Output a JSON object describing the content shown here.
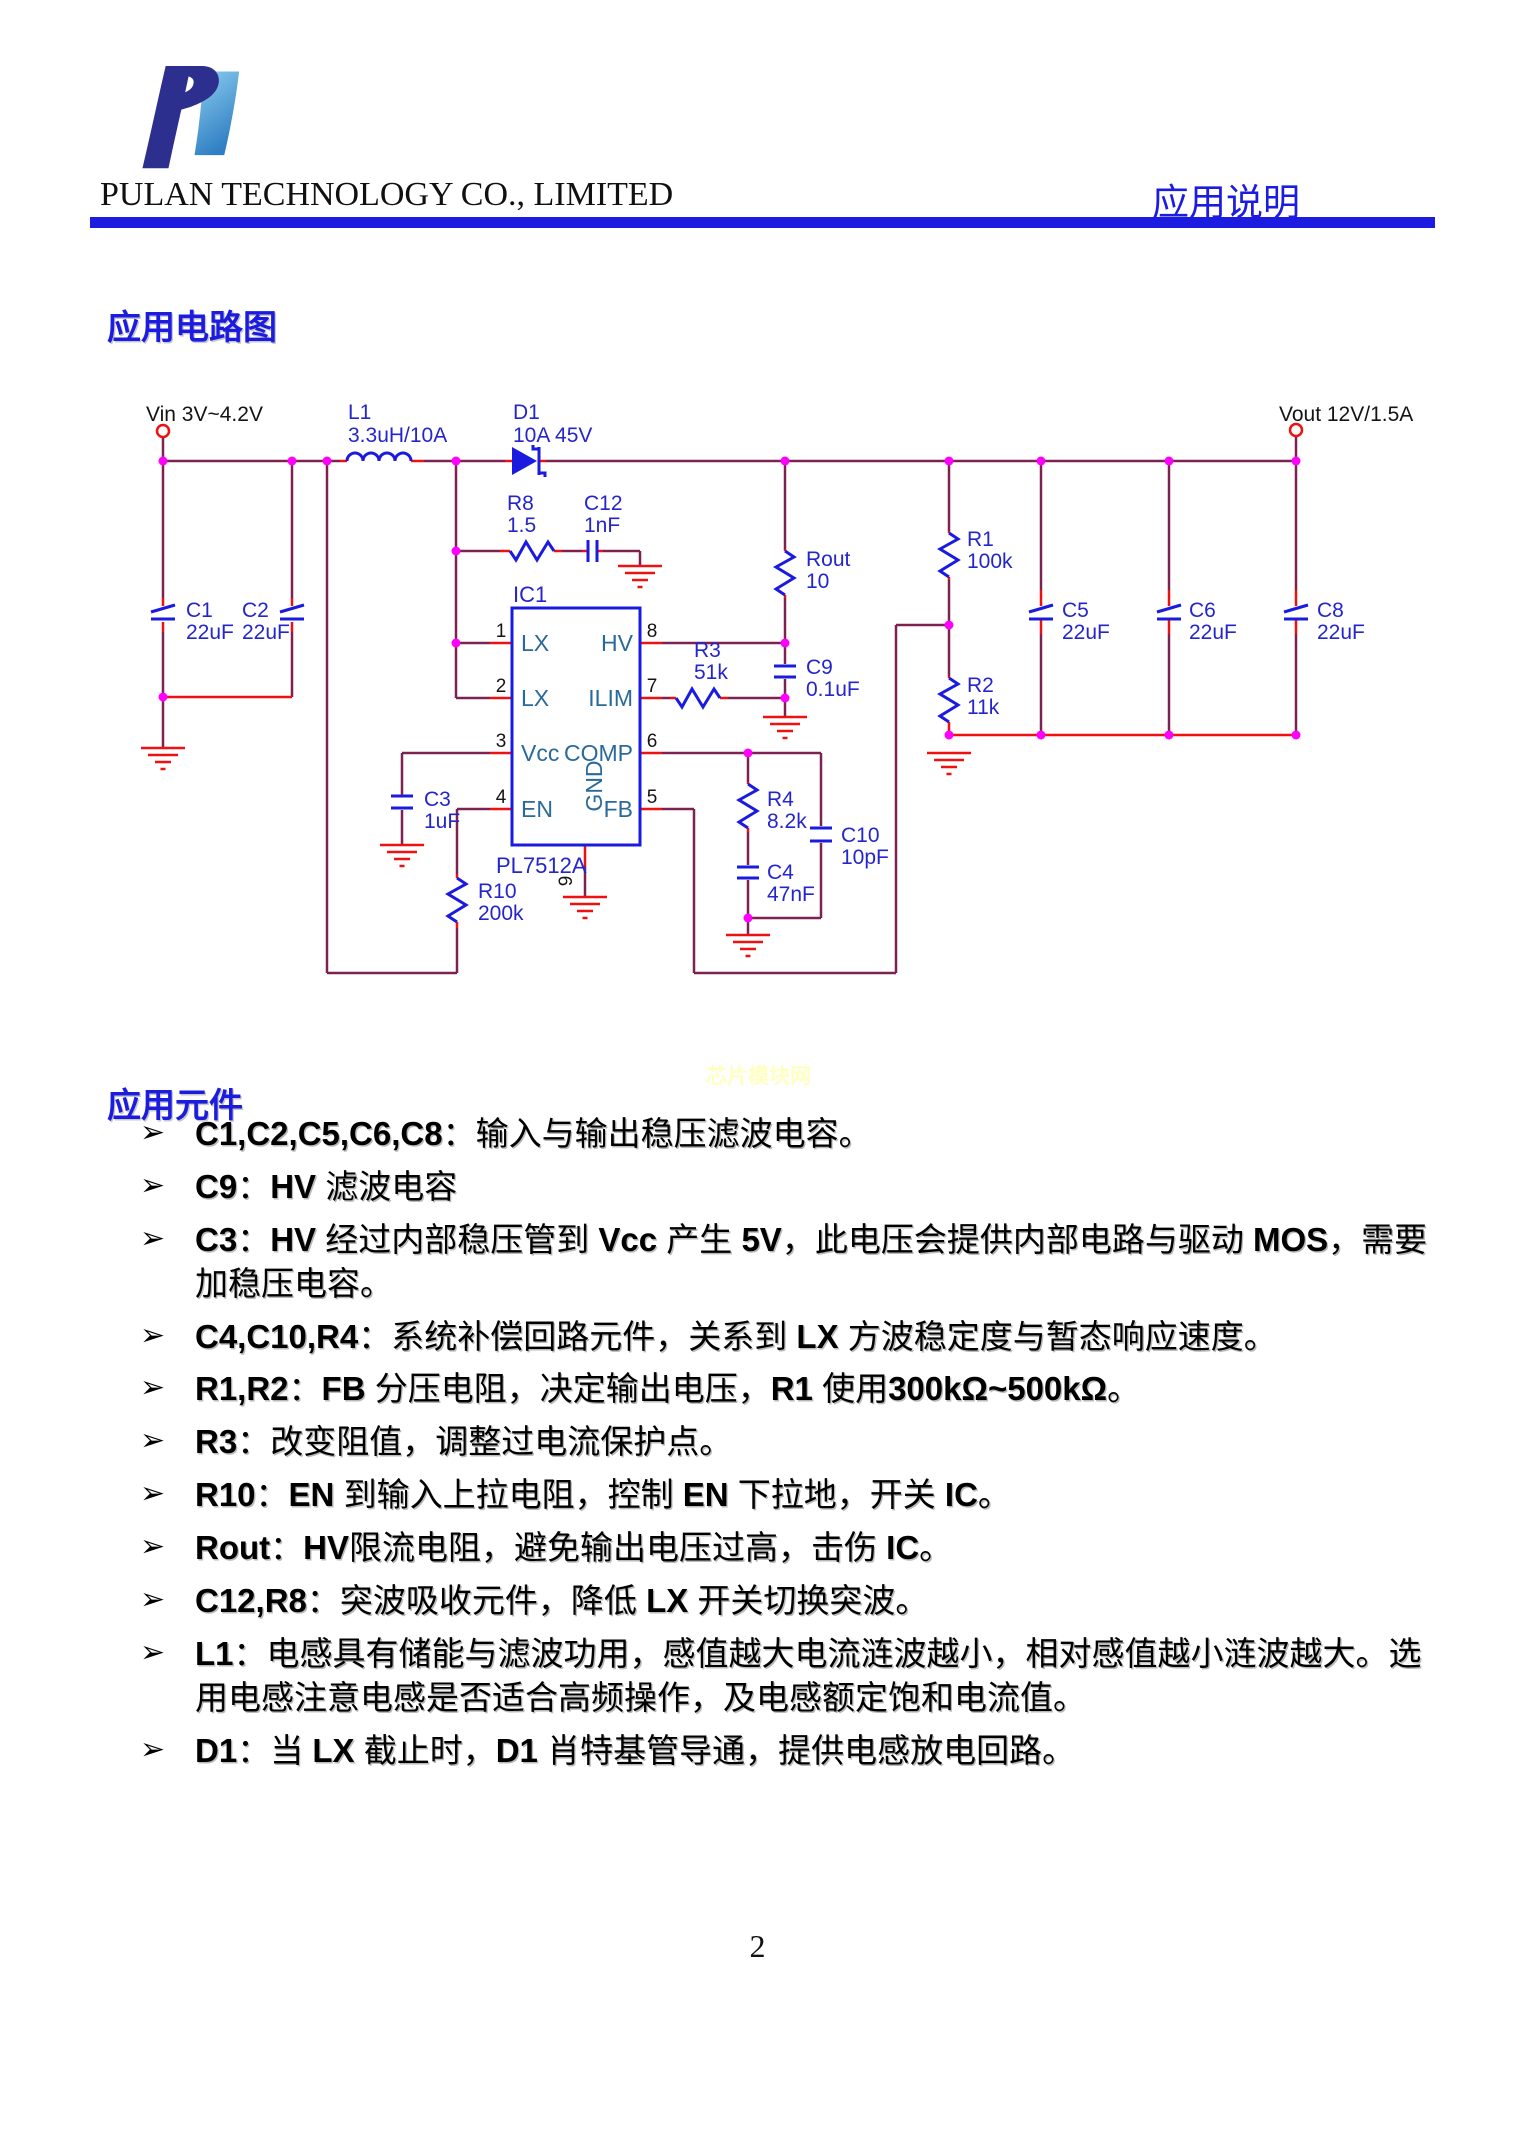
{
  "colors": {
    "accent": "#1c1ce0",
    "bar": "#1c1ce0",
    "wire": "#7d2250",
    "stub": "#ef1010",
    "symbol": "#1b1be0",
    "label": "#2525cc",
    "pinname": "#2a6a9b",
    "junction": "#ff00ff",
    "watermark": "#ffffc2",
    "logodark": "#2d2f8f",
    "logolight": "#5fa8d8"
  },
  "header": {
    "company": "PULAN TECHNOLOGY CO., LIMITED",
    "doc_type": "应用说明"
  },
  "circuit_section": {
    "title": "应用电路图"
  },
  "components_section": {
    "title": "应用元件"
  },
  "watermark": "芯片模块网",
  "page_number": "2",
  "schematic": {
    "vin_label": "Vin 3V~4.2V",
    "vout_label": "Vout 12V/1.5A",
    "ic": {
      "ref": "IC1",
      "part": "PL7512A",
      "left_pins": [
        {
          "num": "1",
          "name": "LX"
        },
        {
          "num": "2",
          "name": "LX"
        },
        {
          "num": "3",
          "name": "Vcc"
        },
        {
          "num": "4",
          "name": "EN"
        }
      ],
      "right_pins": [
        {
          "num": "8",
          "name": "HV"
        },
        {
          "num": "7",
          "name": "ILIM"
        },
        {
          "num": "6",
          "name": "COMP"
        },
        {
          "num": "5",
          "name": "FB"
        }
      ],
      "bottom_pin": {
        "num": "9",
        "name": "GND"
      }
    },
    "parts": {
      "L1": {
        "ref": "L1",
        "val": "3.3uH/10A"
      },
      "D1": {
        "ref": "D1",
        "val": "10A 45V"
      },
      "R8": {
        "ref": "R8",
        "val": "1.5"
      },
      "C12": {
        "ref": "C12",
        "val": "1nF"
      },
      "Rout": {
        "ref": "Rout",
        "val": "10"
      },
      "R3": {
        "ref": "R3",
        "val": "51k"
      },
      "C9": {
        "ref": "C9",
        "val": "0.1uF"
      },
      "R1": {
        "ref": "R1",
        "val": "100k"
      },
      "R2": {
        "ref": "R2",
        "val": "11k"
      },
      "C1": {
        "ref": "C1",
        "val": "22uF"
      },
      "C2": {
        "ref": "C2",
        "val": "22uF"
      },
      "C3": {
        "ref": "C3",
        "val": "1uF"
      },
      "R10": {
        "ref": "R10",
        "val": "200k"
      },
      "R4": {
        "ref": "R4",
        "val": "8.2k"
      },
      "C4": {
        "ref": "C4",
        "val": "47nF"
      },
      "C10": {
        "ref": "C10",
        "val": "10pF"
      },
      "C5": {
        "ref": "C5",
        "val": "22uF"
      },
      "C6": {
        "ref": "C6",
        "val": "22uF"
      },
      "C8": {
        "ref": "C8",
        "val": "22uF"
      }
    }
  },
  "bullet_marker": "➢",
  "bullets": [
    "C1,C2,C5,C6,C8：输入与输出稳压滤波电容。",
    "C9：HV 滤波电容",
    "C3：HV 经过内部稳压管到 Vcc 产生 5V，此电压会提供内部电路与驱动 MOS，需要加稳压电容。",
    "C4,C10,R4：系统补偿回路元件，关系到 LX 方波稳定度与暂态响应速度。",
    "R1,R2：FB 分压电阻，决定输出电压，R1 使用300kΩ~500kΩ。",
    "R3：改变阻值，调整过电流保护点。",
    "R10：EN 到输入上拉电阻，控制 EN 下拉地，开关 IC。",
    "Rout：HV限流电阻，避免输出电压过高，击伤 IC。",
    "C12,R8：突波吸收元件，降低 LX 开关切换突波。",
    "L1：电感具有储能与滤波功用，感值越大电流涟波越小，相对感值越小涟波越大。选用电感注意电感是否适合高频操作，及电感额定饱和电流值。",
    "D1：当 LX 截止时，D1 肖特基管导通，提供电感放电回路。"
  ]
}
